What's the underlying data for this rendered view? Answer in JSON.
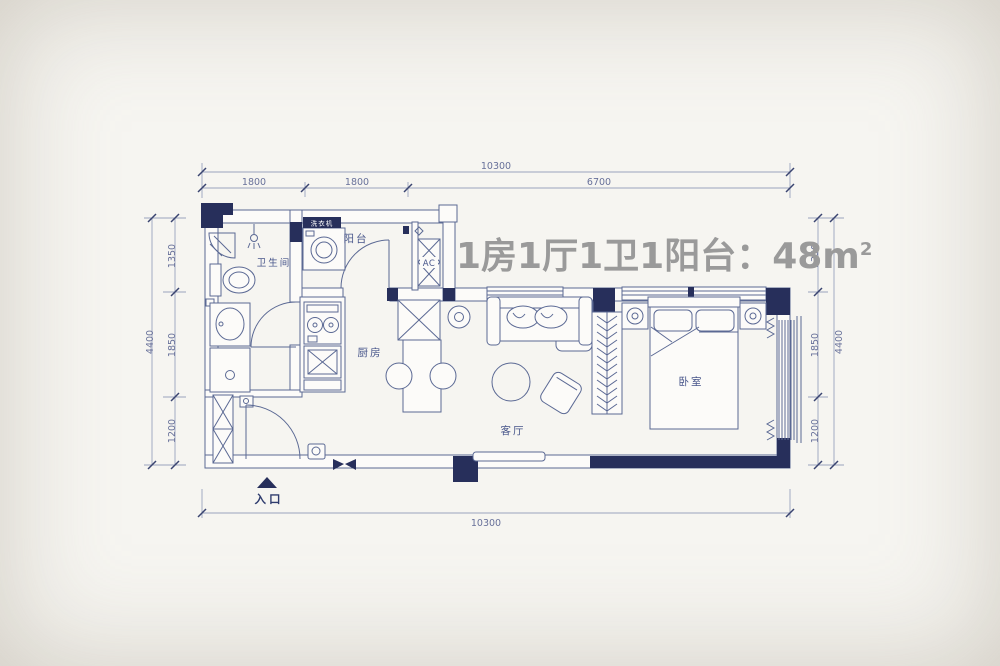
{
  "title": {
    "main": "1房1厅1卫1阳台：48",
    "unit_base": "m",
    "unit_sup": "2"
  },
  "rooms": {
    "bathroom": "卫生间",
    "balcony": "阳台",
    "ac": "AC",
    "kitchen": "厨房",
    "living": "客厅",
    "bedroom": "卧室",
    "entrance": "入口",
    "washer": "洗衣机"
  },
  "dimensions": {
    "top": {
      "total": "10300",
      "seg1": "1800",
      "seg2": "1800",
      "seg3": "6700"
    },
    "bottom": {
      "total": "10300"
    },
    "left": {
      "total": "4400",
      "seg1": "1350",
      "seg2": "1850",
      "seg3": "1200"
    },
    "right": {
      "total": "4400",
      "seg1": "1350",
      "seg2": "1850",
      "seg3": "1200"
    }
  },
  "colors": {
    "background": "#f6f5f1",
    "wall_fill": "#272f5b",
    "wall_line": "#5b6994",
    "dimension": "#68719a",
    "title_text": "#9a9a9a"
  }
}
